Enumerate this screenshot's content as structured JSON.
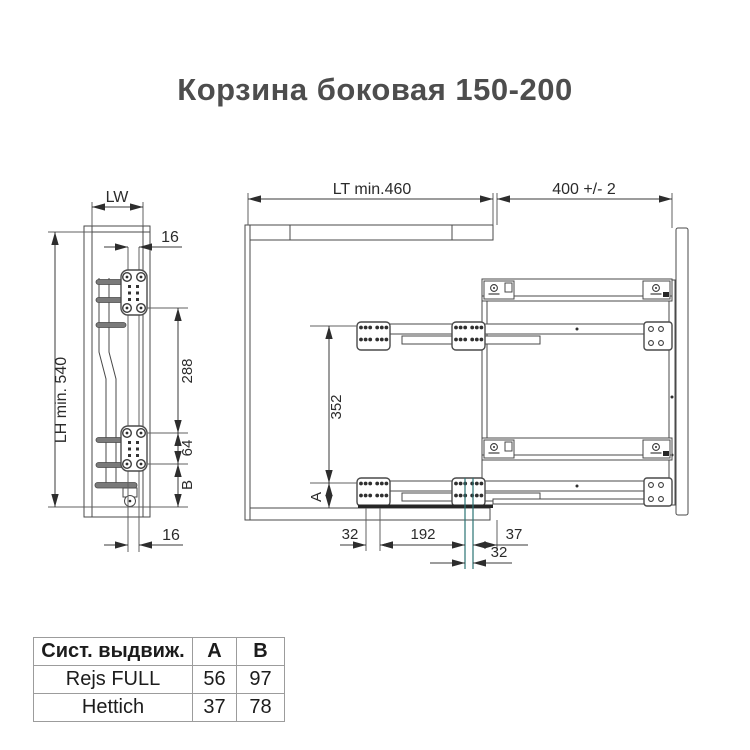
{
  "title": "Корзина боковая 150-200",
  "front_view": {
    "dim_width_label": "LW",
    "dim_rail_offset_top": "16",
    "dim_height_label": "LH min. 540",
    "dim_bracket_spacing": "288",
    "dim_hole_spacing": "64",
    "dim_bottom_distance": "B",
    "dim_rail_offset_bottom": "16"
  },
  "side_view": {
    "dim_depth_label": "LT min.460",
    "dim_extension_label": "400 +/- 2",
    "dim_bracket_spacing": "352",
    "dim_floor_distance": "A",
    "dim_front_offset": "32",
    "dim_bracket_pitch": "192",
    "dim_rear_offset": "37",
    "dim_rear_offset2": "32"
  },
  "table": {
    "headers": [
      "Сист. выдвиж.",
      "A",
      "B"
    ],
    "rows": [
      {
        "system": "Rejs FULL",
        "a": "56",
        "b": "97"
      },
      {
        "system": "Hettich",
        "a": "37",
        "b": "78"
      }
    ]
  },
  "colors": {
    "line": "#4a4a4a",
    "dimension_text": "#2b2b2b",
    "accent_extension_line": "#2a7373",
    "title_text": "#4d4d4d",
    "table_border": "#9c9c9c"
  }
}
